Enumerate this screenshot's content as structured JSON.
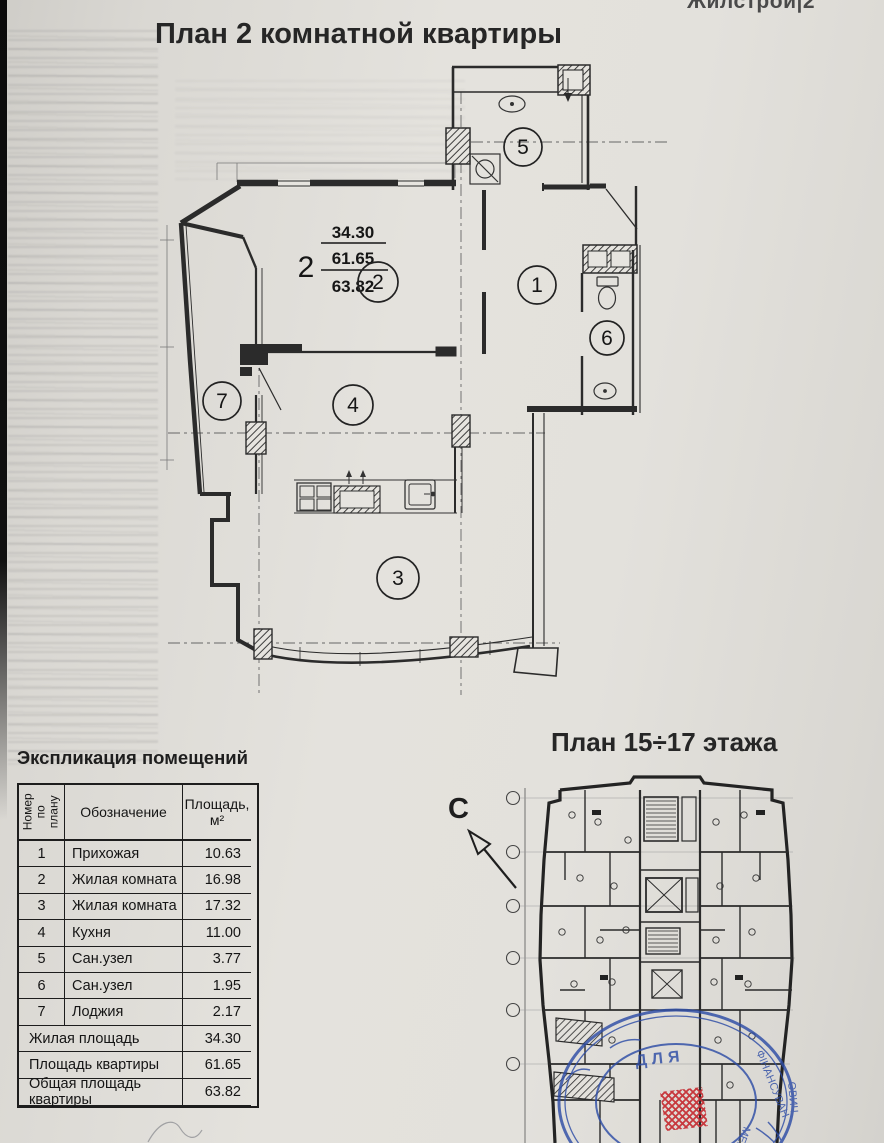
{
  "page": {
    "title": "План 2 комнатной квартиры",
    "logo": "Жилстрой|2"
  },
  "colors": {
    "paper": "#e3e1dc",
    "ink": "#2b2b2b",
    "stamp_blue": "#2e4da6",
    "marker_red": "#c62f35"
  },
  "main_plan": {
    "label": {
      "count": "2",
      "living": "34.30",
      "flat": "61.65",
      "total": "63.82"
    },
    "rooms": [
      "1",
      "2",
      "3",
      "4",
      "5",
      "6",
      "7"
    ]
  },
  "small_plan": {
    "title": "План 15÷17  этажа",
    "north": "С"
  },
  "stamp": {
    "fragments": [
      "ДЛЯ",
      "ФІНАНСУВАН",
      "МЕНТІ",
      "ОВИЧ"
    ]
  },
  "table": {
    "title": "Экспликация помещений",
    "headers": {
      "num": "Номер по плану",
      "name": "Обозначение",
      "area1": "Площадь,",
      "area2": "м²"
    },
    "rows": [
      {
        "num": "1",
        "name": "Прихожая",
        "area": "10.63"
      },
      {
        "num": "2",
        "name": "Жилая комната",
        "area": "16.98"
      },
      {
        "num": "3",
        "name": "Жилая комната",
        "area": "17.32"
      },
      {
        "num": "4",
        "name": "Кухня",
        "area": "11.00"
      },
      {
        "num": "5",
        "name": "Сан.узел",
        "area": "3.77"
      },
      {
        "num": "6",
        "name": "Сан.узел",
        "area": "1.95"
      },
      {
        "num": "7",
        "name": "Лоджия",
        "area": "2.17"
      }
    ],
    "totals": [
      {
        "label": "Жилая площадь",
        "value": "34.30"
      },
      {
        "label": "Площадь квартиры",
        "value": "61.65"
      },
      {
        "label": "Общая площадь квартиры",
        "value": "63.82"
      }
    ]
  }
}
